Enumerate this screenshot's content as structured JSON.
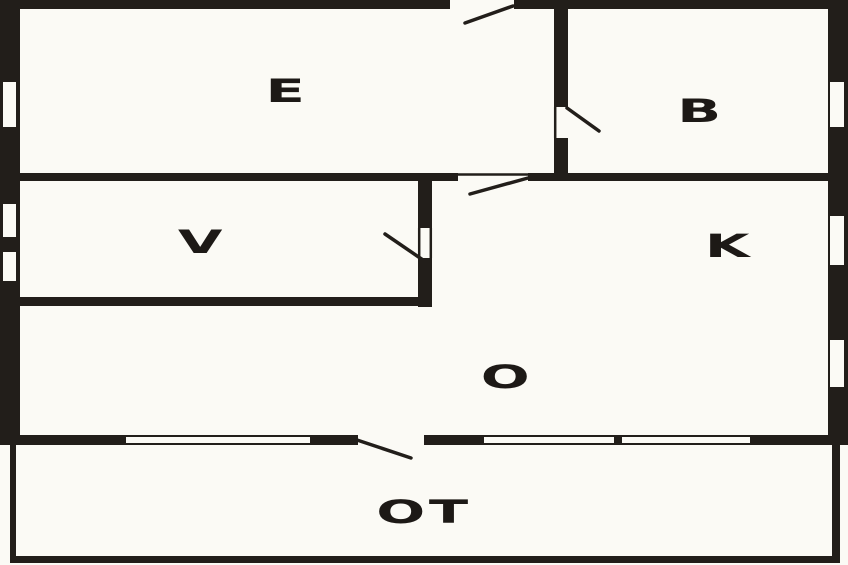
{
  "floorplan": {
    "rooms": [
      {
        "label": "E"
      },
      {
        "label": "B"
      },
      {
        "label": "V"
      },
      {
        "label": "K"
      },
      {
        "label": "O"
      },
      {
        "label": "OT"
      }
    ],
    "colors": {
      "wall": "#221e1a",
      "floor": "#fbfaf5",
      "label_text": "#1d1916"
    }
  }
}
